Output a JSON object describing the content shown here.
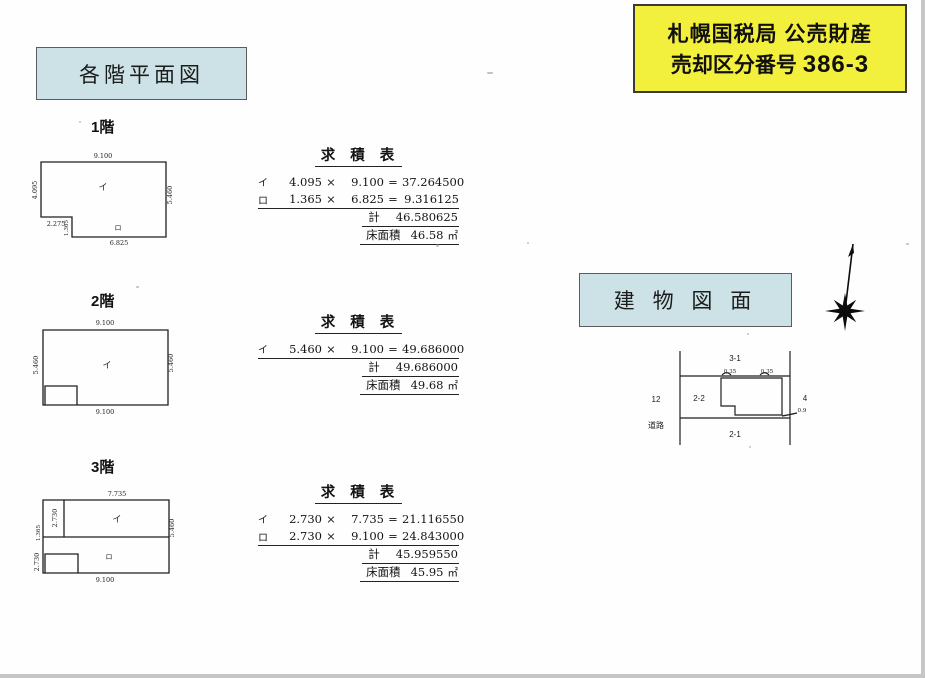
{
  "header": {
    "line1": "札幌国税局 公売財産",
    "line2_label": "売却区分番号",
    "line2_number": "386-3"
  },
  "titles": {
    "floor_plans": "各階平面図",
    "building_drawing": "建 物 図 面"
  },
  "symbols": {
    "times": "×",
    "equals": "="
  },
  "floors": [
    {
      "label": "1階",
      "marks": {
        "a": "イ",
        "b": "ロ"
      },
      "dims": {
        "top": "9.100",
        "left": "4.095",
        "right": "5.460",
        "offset": "2.275",
        "strip": "1.365",
        "bottom": "6.825"
      },
      "table": {
        "title": "求 積 表",
        "rows": [
          {
            "mark": "イ",
            "w": "4.095",
            "h": "9.100",
            "val": "37.264500"
          },
          {
            "mark": "ロ",
            "w": "1.365",
            "h": "6.825",
            "val": "9.316125"
          }
        ],
        "total_label": "計",
        "total": "46.580625",
        "floor_area_label": "床面積",
        "floor_area": "46.58",
        "unit": "㎡"
      }
    },
    {
      "label": "2階",
      "marks": {
        "a": "イ"
      },
      "dims": {
        "top": "9.100",
        "left": "5.460",
        "right": "5.460",
        "bottom": "9.100"
      },
      "table": {
        "title": "求 積 表",
        "rows": [
          {
            "mark": "イ",
            "w": "5.460",
            "h": "9.100",
            "val": "49.686000"
          }
        ],
        "total_label": "計",
        "total": "49.686000",
        "floor_area_label": "床面積",
        "floor_area": "49.68",
        "unit": "㎡"
      }
    },
    {
      "label": "3階",
      "marks": {
        "a": "イ",
        "b": "ロ"
      },
      "dims": {
        "top": "7.735",
        "upper_left": "2.730",
        "mid_left": "1.365",
        "lower_left": "2.730",
        "right": "5.460",
        "bottom": "9.100"
      },
      "table": {
        "title": "求 積 表",
        "rows": [
          {
            "mark": "イ",
            "w": "2.730",
            "h": "7.735",
            "val": "21.116550"
          },
          {
            "mark": "ロ",
            "w": "2.730",
            "h": "9.100",
            "val": "24.843000"
          }
        ],
        "total_label": "計",
        "total": "45.959550",
        "floor_area_label": "床面積",
        "floor_area": "45.95",
        "unit": "㎡"
      }
    }
  ],
  "site_plan": {
    "parcels": {
      "top": "3-1",
      "west": "12",
      "inner": "2-2",
      "south": "2-1",
      "east": "4"
    },
    "road": "道路",
    "dims": {
      "setback_left": "0.35",
      "setback_right": "0.35",
      "gap": "0.9"
    }
  },
  "colors": {
    "header_bg": "#f3ef3d",
    "title_bg": "#cde2e6",
    "ink": "#1d1d1d"
  }
}
